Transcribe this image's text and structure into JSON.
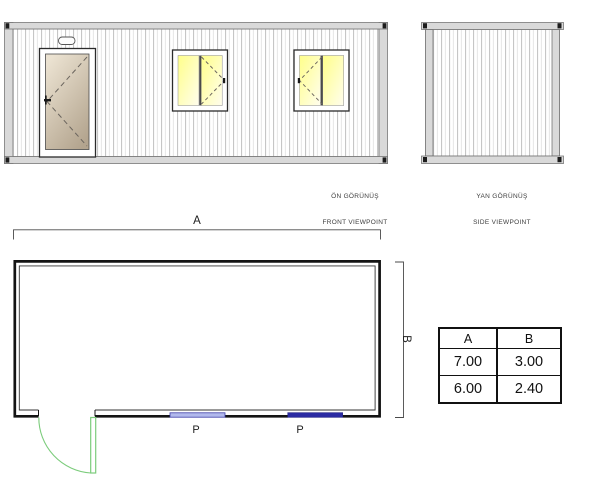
{
  "drawing": {
    "front_view": {
      "caption_line1": "ÖN GÖRÜNÜŞ",
      "caption_line2": "FRONT VIEWPOINT"
    },
    "side_view": {
      "caption_line1": "YAN GÖRÜNÜŞ",
      "caption_line2": "SIDE VIEWPOINT"
    },
    "plan": {
      "width_dim_label": "A",
      "depth_dim_label": "B",
      "window_marks": [
        "P",
        "P"
      ]
    }
  },
  "dimension_table": {
    "columns": [
      "A",
      "B"
    ],
    "rows": [
      [
        "7.00",
        "3.00"
      ],
      [
        "6.00",
        "2.40"
      ]
    ]
  },
  "colors": {
    "frame_gray": "#d9d9d9",
    "wall_ink": "#141414",
    "dim_ink": "#4a4a4a",
    "window_glass_yellow": "#ffff8a",
    "window_glass_pale": "#fffdee",
    "door_panel_light": "#ebe2d1",
    "door_panel_dark": "#b3a48e",
    "door_swing_green": "#7ccc7c",
    "plan_window_light_blue": "#b2b9ec",
    "plan_window_dark_blue": "#2b2ba3"
  }
}
